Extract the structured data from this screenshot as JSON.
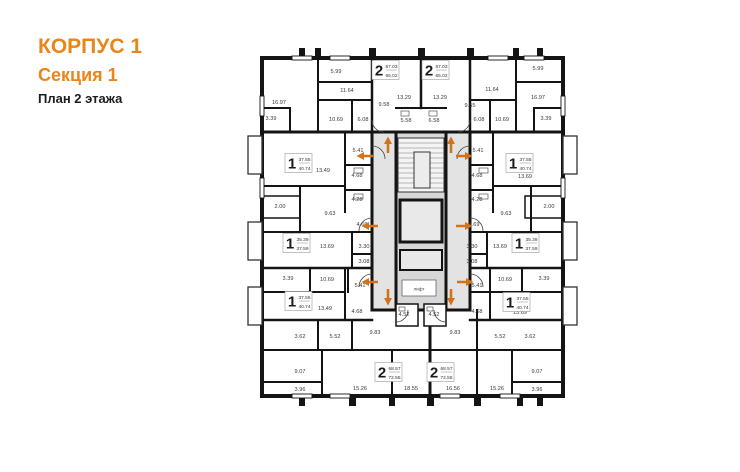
{
  "title": {
    "building": "КОРПУС 1",
    "section": "Секция 1",
    "floor": "План 2 этажа"
  },
  "colors": {
    "accent": "#E8861A",
    "wall": "#141414",
    "corridor_fill": "#e3e3e3",
    "core_fill": "#d7d7d7",
    "arrow": "#D2731C",
    "label_text": "#3a3a3a"
  },
  "plan": {
    "elevator_label": "лифт",
    "apartments": [
      {
        "rooms": "2",
        "area1": "57.03",
        "area2": "65.02",
        "x": 385,
        "y": 70
      },
      {
        "rooms": "2",
        "area1": "57.03",
        "area2": "65.02",
        "x": 435,
        "y": 70
      },
      {
        "rooms": "1",
        "area1": "37.55",
        "area2": "40.74",
        "x": 298,
        "y": 163
      },
      {
        "rooms": "1",
        "area1": "37.55",
        "area2": "40.74",
        "x": 519,
        "y": 163
      },
      {
        "rooms": "1",
        "area1": "35.39",
        "area2": "37.59",
        "x": 296,
        "y": 243
      },
      {
        "rooms": "1",
        "area1": "35.39",
        "area2": "37.59",
        "x": 525,
        "y": 243
      },
      {
        "rooms": "1",
        "area1": "37.55",
        "area2": "40.74",
        "x": 298,
        "y": 301
      },
      {
        "rooms": "1",
        "area1": "37.55",
        "area2": "40.74",
        "x": 516,
        "y": 302
      },
      {
        "rooms": "2",
        "area1": "68.57",
        "area2": "72.55",
        "x": 388,
        "y": 372
      },
      {
        "rooms": "2",
        "area1": "68.57",
        "area2": "72.55",
        "x": 440,
        "y": 372
      }
    ],
    "room_areas": [
      {
        "v": "5.99",
        "x": 336,
        "y": 73
      },
      {
        "v": "11.64",
        "x": 347,
        "y": 92
      },
      {
        "v": "16.97",
        "x": 279,
        "y": 104
      },
      {
        "v": "3.39",
        "x": 271,
        "y": 120
      },
      {
        "v": "10.69",
        "x": 336,
        "y": 121
      },
      {
        "v": "6.08",
        "x": 363,
        "y": 121
      },
      {
        "v": "5.41",
        "x": 358,
        "y": 152
      },
      {
        "v": "13.49",
        "x": 323,
        "y": 172
      },
      {
        "v": "4.68",
        "x": 357,
        "y": 177
      },
      {
        "v": "4.28",
        "x": 357,
        "y": 201
      },
      {
        "v": "2.00",
        "x": 280,
        "y": 208
      },
      {
        "v": "9.63",
        "x": 330,
        "y": 215
      },
      {
        "v": "4.69",
        "x": 362,
        "y": 226
      },
      {
        "v": "13.69",
        "x": 327,
        "y": 248
      },
      {
        "v": "3.30",
        "x": 364,
        "y": 248
      },
      {
        "v": "3.08",
        "x": 364,
        "y": 263
      },
      {
        "v": "3.39",
        "x": 288,
        "y": 280
      },
      {
        "v": "10.69",
        "x": 327,
        "y": 281
      },
      {
        "v": "5.41",
        "x": 360,
        "y": 287
      },
      {
        "v": "13.49",
        "x": 325,
        "y": 310
      },
      {
        "v": "4.68",
        "x": 357,
        "y": 313
      },
      {
        "v": "3.62",
        "x": 300,
        "y": 338
      },
      {
        "v": "5.52",
        "x": 335,
        "y": 338
      },
      {
        "v": "9.83",
        "x": 375,
        "y": 334
      },
      {
        "v": "9.07",
        "x": 300,
        "y": 373
      },
      {
        "v": "3.96",
        "x": 300,
        "y": 391
      },
      {
        "v": "15.26",
        "x": 360,
        "y": 390
      },
      {
        "v": "9.58",
        "x": 384,
        "y": 106
      },
      {
        "v": "13.29",
        "x": 404,
        "y": 99
      },
      {
        "v": "13.29",
        "x": 440,
        "y": 99
      },
      {
        "v": "9.55",
        "x": 470,
        "y": 107
      },
      {
        "v": "5.58",
        "x": 406,
        "y": 122
      },
      {
        "v": "6.58",
        "x": 434,
        "y": 122
      },
      {
        "v": "4.52",
        "x": 404,
        "y": 316
      },
      {
        "v": "4.52",
        "x": 434,
        "y": 316
      },
      {
        "v": "18.55",
        "x": 411,
        "y": 390
      },
      {
        "v": "16.56",
        "x": 453,
        "y": 390
      },
      {
        "v": "5.99",
        "x": 538,
        "y": 70
      },
      {
        "v": "11.64",
        "x": 492,
        "y": 91
      },
      {
        "v": "16.97",
        "x": 538,
        "y": 99
      },
      {
        "v": "3.39",
        "x": 546,
        "y": 120
      },
      {
        "v": "10.69",
        "x": 502,
        "y": 121
      },
      {
        "v": "6.08",
        "x": 479,
        "y": 121
      },
      {
        "v": "5.41",
        "x": 478,
        "y": 152
      },
      {
        "v": "13.69",
        "x": 525,
        "y": 178
      },
      {
        "v": "4.68",
        "x": 477,
        "y": 177
      },
      {
        "v": "4.28",
        "x": 477,
        "y": 201
      },
      {
        "v": "2.00",
        "x": 549,
        "y": 208
      },
      {
        "v": "9.63",
        "x": 506,
        "y": 215
      },
      {
        "v": "4.69",
        "x": 474,
        "y": 226
      },
      {
        "v": "13.69",
        "x": 500,
        "y": 248
      },
      {
        "v": "3.30",
        "x": 472,
        "y": 248
      },
      {
        "v": "3.08",
        "x": 472,
        "y": 263
      },
      {
        "v": "3.39",
        "x": 544,
        "y": 280
      },
      {
        "v": "10.69",
        "x": 505,
        "y": 281
      },
      {
        "v": "5.41",
        "x": 477,
        "y": 287
      },
      {
        "v": "13.69",
        "x": 520,
        "y": 314
      },
      {
        "v": "4.68",
        "x": 477,
        "y": 313
      },
      {
        "v": "3.62",
        "x": 530,
        "y": 338
      },
      {
        "v": "5.52",
        "x": 500,
        "y": 338
      },
      {
        "v": "9.83",
        "x": 455,
        "y": 334
      },
      {
        "v": "9.07",
        "x": 537,
        "y": 373
      },
      {
        "v": "3.96",
        "x": 537,
        "y": 391
      },
      {
        "v": "15.26",
        "x": 497,
        "y": 390
      }
    ],
    "arrows": [
      {
        "dir": "up",
        "x": 388,
        "y": 145
      },
      {
        "dir": "up",
        "x": 451,
        "y": 145
      },
      {
        "dir": "left",
        "x": 365,
        "y": 156
      },
      {
        "dir": "right",
        "x": 464,
        "y": 156
      },
      {
        "dir": "left",
        "x": 370,
        "y": 226
      },
      {
        "dir": "right",
        "x": 464,
        "y": 226
      },
      {
        "dir": "left",
        "x": 370,
        "y": 282
      },
      {
        "dir": "right",
        "x": 465,
        "y": 282
      },
      {
        "dir": "down",
        "x": 388,
        "y": 297
      },
      {
        "dir": "down",
        "x": 451,
        "y": 297
      }
    ]
  }
}
